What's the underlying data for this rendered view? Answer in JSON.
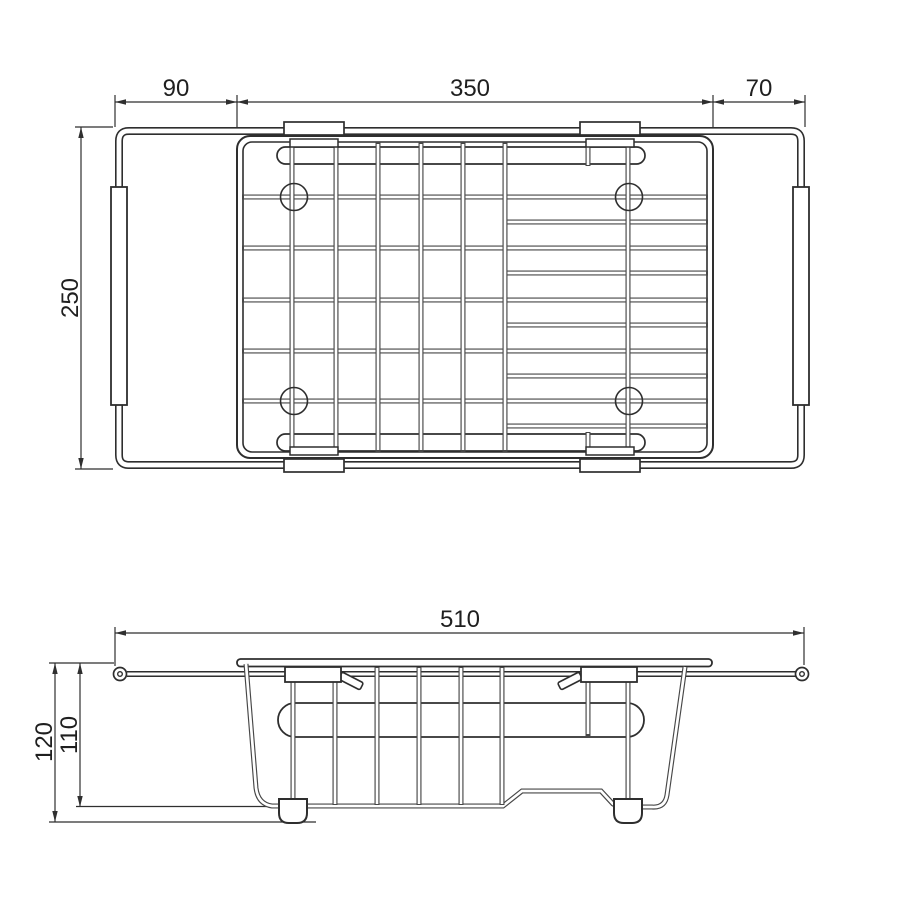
{
  "colors": {
    "background": "#ffffff",
    "line": "#2e2e2e",
    "text": "#1f1f1f"
  },
  "top_view": {
    "dim_arm_left": "90",
    "dim_basket_width": "350",
    "dim_arm_right": "70",
    "dim_depth": "250"
  },
  "side_view": {
    "dim_total_width": "510",
    "dim_overall_height": "120",
    "dim_basket_height": "110"
  }
}
